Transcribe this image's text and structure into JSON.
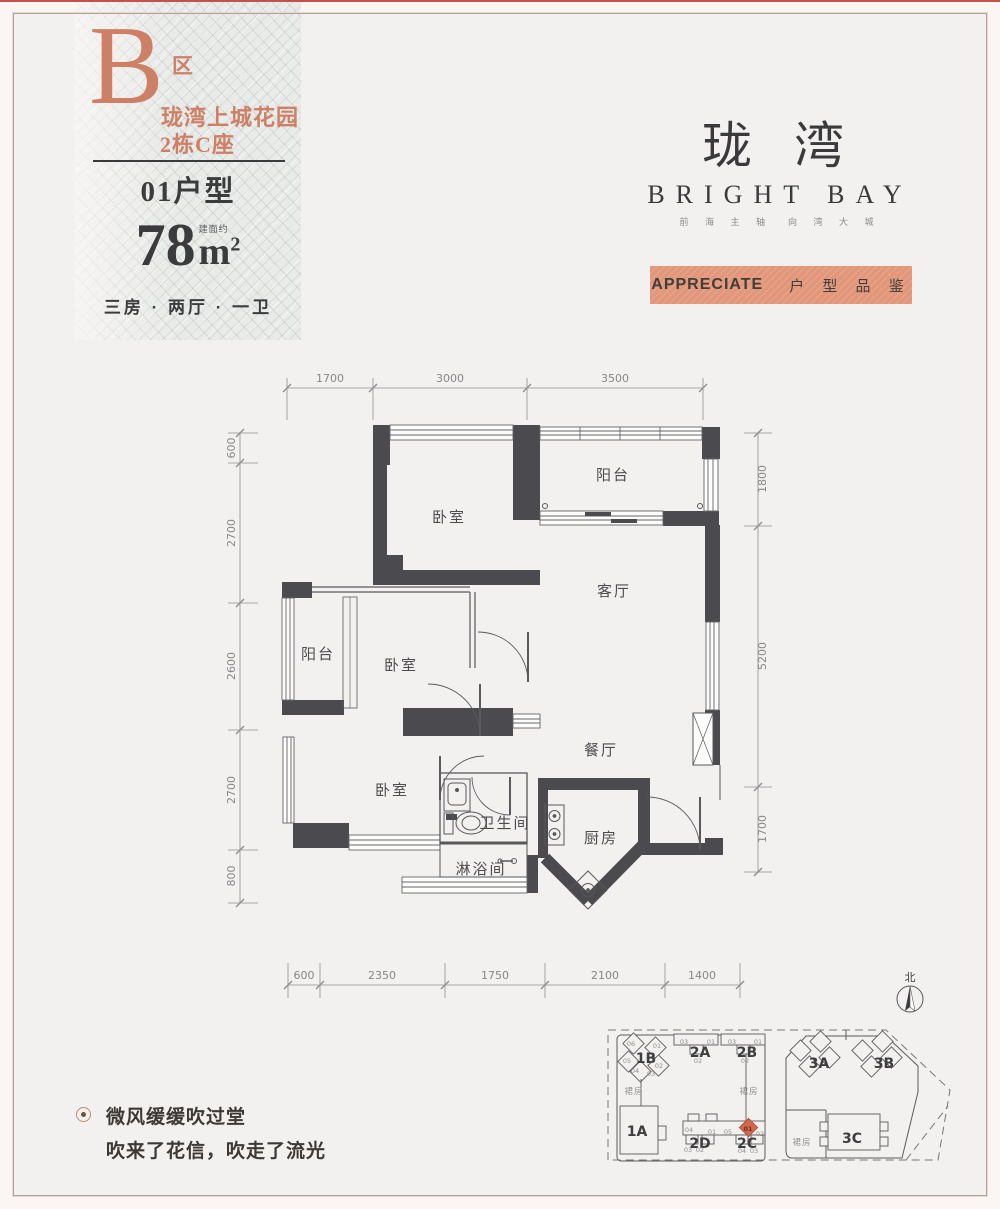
{
  "unit_card": {
    "zone_letter": "B",
    "zone_suffix": "区",
    "project_name": "珑湾上城花园",
    "building": "2栋C座",
    "unit_no": "01户型",
    "area_prefix": "建面约",
    "area_value": "78",
    "area_unit": "m",
    "area_sup": "2",
    "layout_desc": "三房 · 两厅 · 一卫"
  },
  "brand": {
    "name_cn": "珑 湾",
    "name_en": "BRIGHT BAY",
    "tagline": "前 海 主 轴　向 湾 大 城",
    "banner_en": "APPRECIATE",
    "banner_cn": "户 型 品 鉴",
    "accent_color": "#cd8066",
    "banner_color": "#e2967a"
  },
  "floor_plan": {
    "rooms": [
      {
        "id": "bedroom-top",
        "label": "卧室"
      },
      {
        "id": "balcony-top",
        "label": "阳台"
      },
      {
        "id": "living-room",
        "label": "客厅"
      },
      {
        "id": "dining-room",
        "label": "餐厅"
      },
      {
        "id": "balcony-left",
        "label": "阳台"
      },
      {
        "id": "bedroom-middle",
        "label": "卧室"
      },
      {
        "id": "bedroom-bottom",
        "label": "卧室"
      },
      {
        "id": "bathroom",
        "label": "卫生间"
      },
      {
        "id": "shower-room",
        "label": "淋浴间"
      },
      {
        "id": "kitchen",
        "label": "厨房"
      }
    ],
    "dims_top": [
      "1700",
      "3000",
      "3500"
    ],
    "dims_left": [
      "600",
      "2700",
      "2600",
      "2700",
      "800"
    ],
    "dims_right": [
      "1800",
      "5200",
      "1700"
    ],
    "dims_bottom": [
      "600",
      "2350",
      "1750",
      "2100",
      "1400"
    ]
  },
  "compass": {
    "label": "北"
  },
  "site_plan": {
    "buildings": [
      {
        "label": "1B"
      },
      {
        "label": "2A"
      },
      {
        "label": "2B"
      },
      {
        "label": "1A"
      },
      {
        "label": "2D"
      },
      {
        "label": "2C"
      },
      {
        "label": "3A"
      },
      {
        "label": "3B"
      },
      {
        "label": "3C"
      }
    ],
    "podium_labels": [
      "裙房",
      "裙房",
      "裙房"
    ],
    "highlight_color": "#cd6a50",
    "units": [
      {
        "t": "06",
        "x": 631,
        "y": 1046
      },
      {
        "t": "01",
        "x": 657,
        "y": 1048
      },
      {
        "t": "05",
        "x": 627,
        "y": 1063
      },
      {
        "t": "04",
        "x": 635,
        "y": 1073
      },
      {
        "t": "02",
        "x": 659,
        "y": 1068
      },
      {
        "t": "03",
        "x": 651,
        "y": 1076
      },
      {
        "t": "03",
        "x": 684,
        "y": 1044
      },
      {
        "t": "01",
        "x": 711,
        "y": 1044
      },
      {
        "t": "02",
        "x": 698,
        "y": 1063
      },
      {
        "t": "03",
        "x": 732,
        "y": 1044
      },
      {
        "t": "01",
        "x": 758,
        "y": 1044
      },
      {
        "t": "02",
        "x": 745,
        "y": 1063
      },
      {
        "t": "04",
        "x": 689,
        "y": 1132
      },
      {
        "t": "01",
        "x": 712,
        "y": 1134
      },
      {
        "t": "05",
        "x": 728,
        "y": 1134
      },
      {
        "t": "03",
        "x": 688,
        "y": 1152
      },
      {
        "t": "02",
        "x": 700,
        "y": 1152
      },
      {
        "t": "01",
        "x": 748,
        "y": 1131,
        "hl": true
      },
      {
        "t": "02",
        "x": 760,
        "y": 1136
      },
      {
        "t": "04",
        "x": 742,
        "y": 1153
      },
      {
        "t": "03",
        "x": 754,
        "y": 1153
      }
    ]
  },
  "footer": {
    "line1": "微风缓缓吹过堂",
    "line2": "吹来了花信，吹走了流光"
  }
}
